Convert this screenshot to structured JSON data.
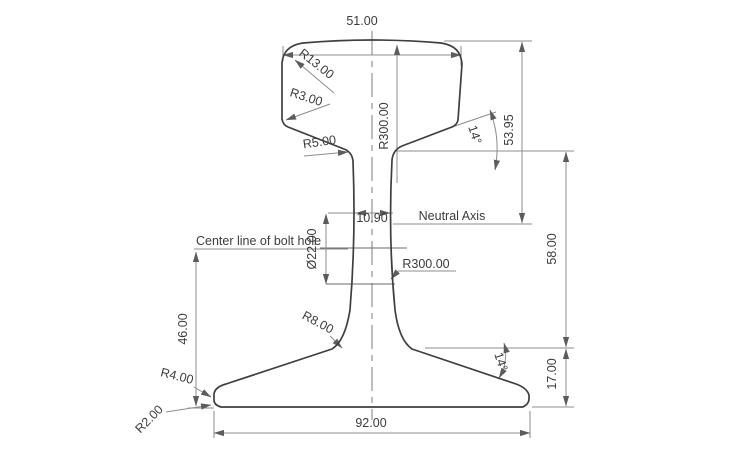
{
  "drawing": {
    "type": "rail-cross-section-engineering-drawing",
    "labels": {
      "head_width": "51.00",
      "head_corner_radius": "R13.00",
      "head_side_radius": "R3.00",
      "head_crown_radius": "R300.00",
      "head_underside_angle": "14°",
      "head_height_to_neutral_axis": "53.95",
      "head_web_fillet_radius": "R5.00",
      "web_thickness": "10.90",
      "neutral_axis": "Neutral Axis",
      "bolt_hole_centerline": "Center line of bolt hole",
      "bolt_hole_diameter": "Ø22.00",
      "web_side_radius": "R300.00",
      "web_height": "58.00",
      "web_foot_fillet_radius": "R8.00",
      "bolt_hole_center_height": "46.00",
      "foot_top_angle": "14°",
      "foot_height": "17.00",
      "foot_edge_radius": "R4.00",
      "foot_base_radius": "R2.00",
      "foot_width": "92.00"
    },
    "colors": {
      "background": "#ffffff",
      "outline": "#3f3f3f",
      "dimension_lines": "#8c8c8c",
      "text": "#3c3c3c"
    }
  }
}
